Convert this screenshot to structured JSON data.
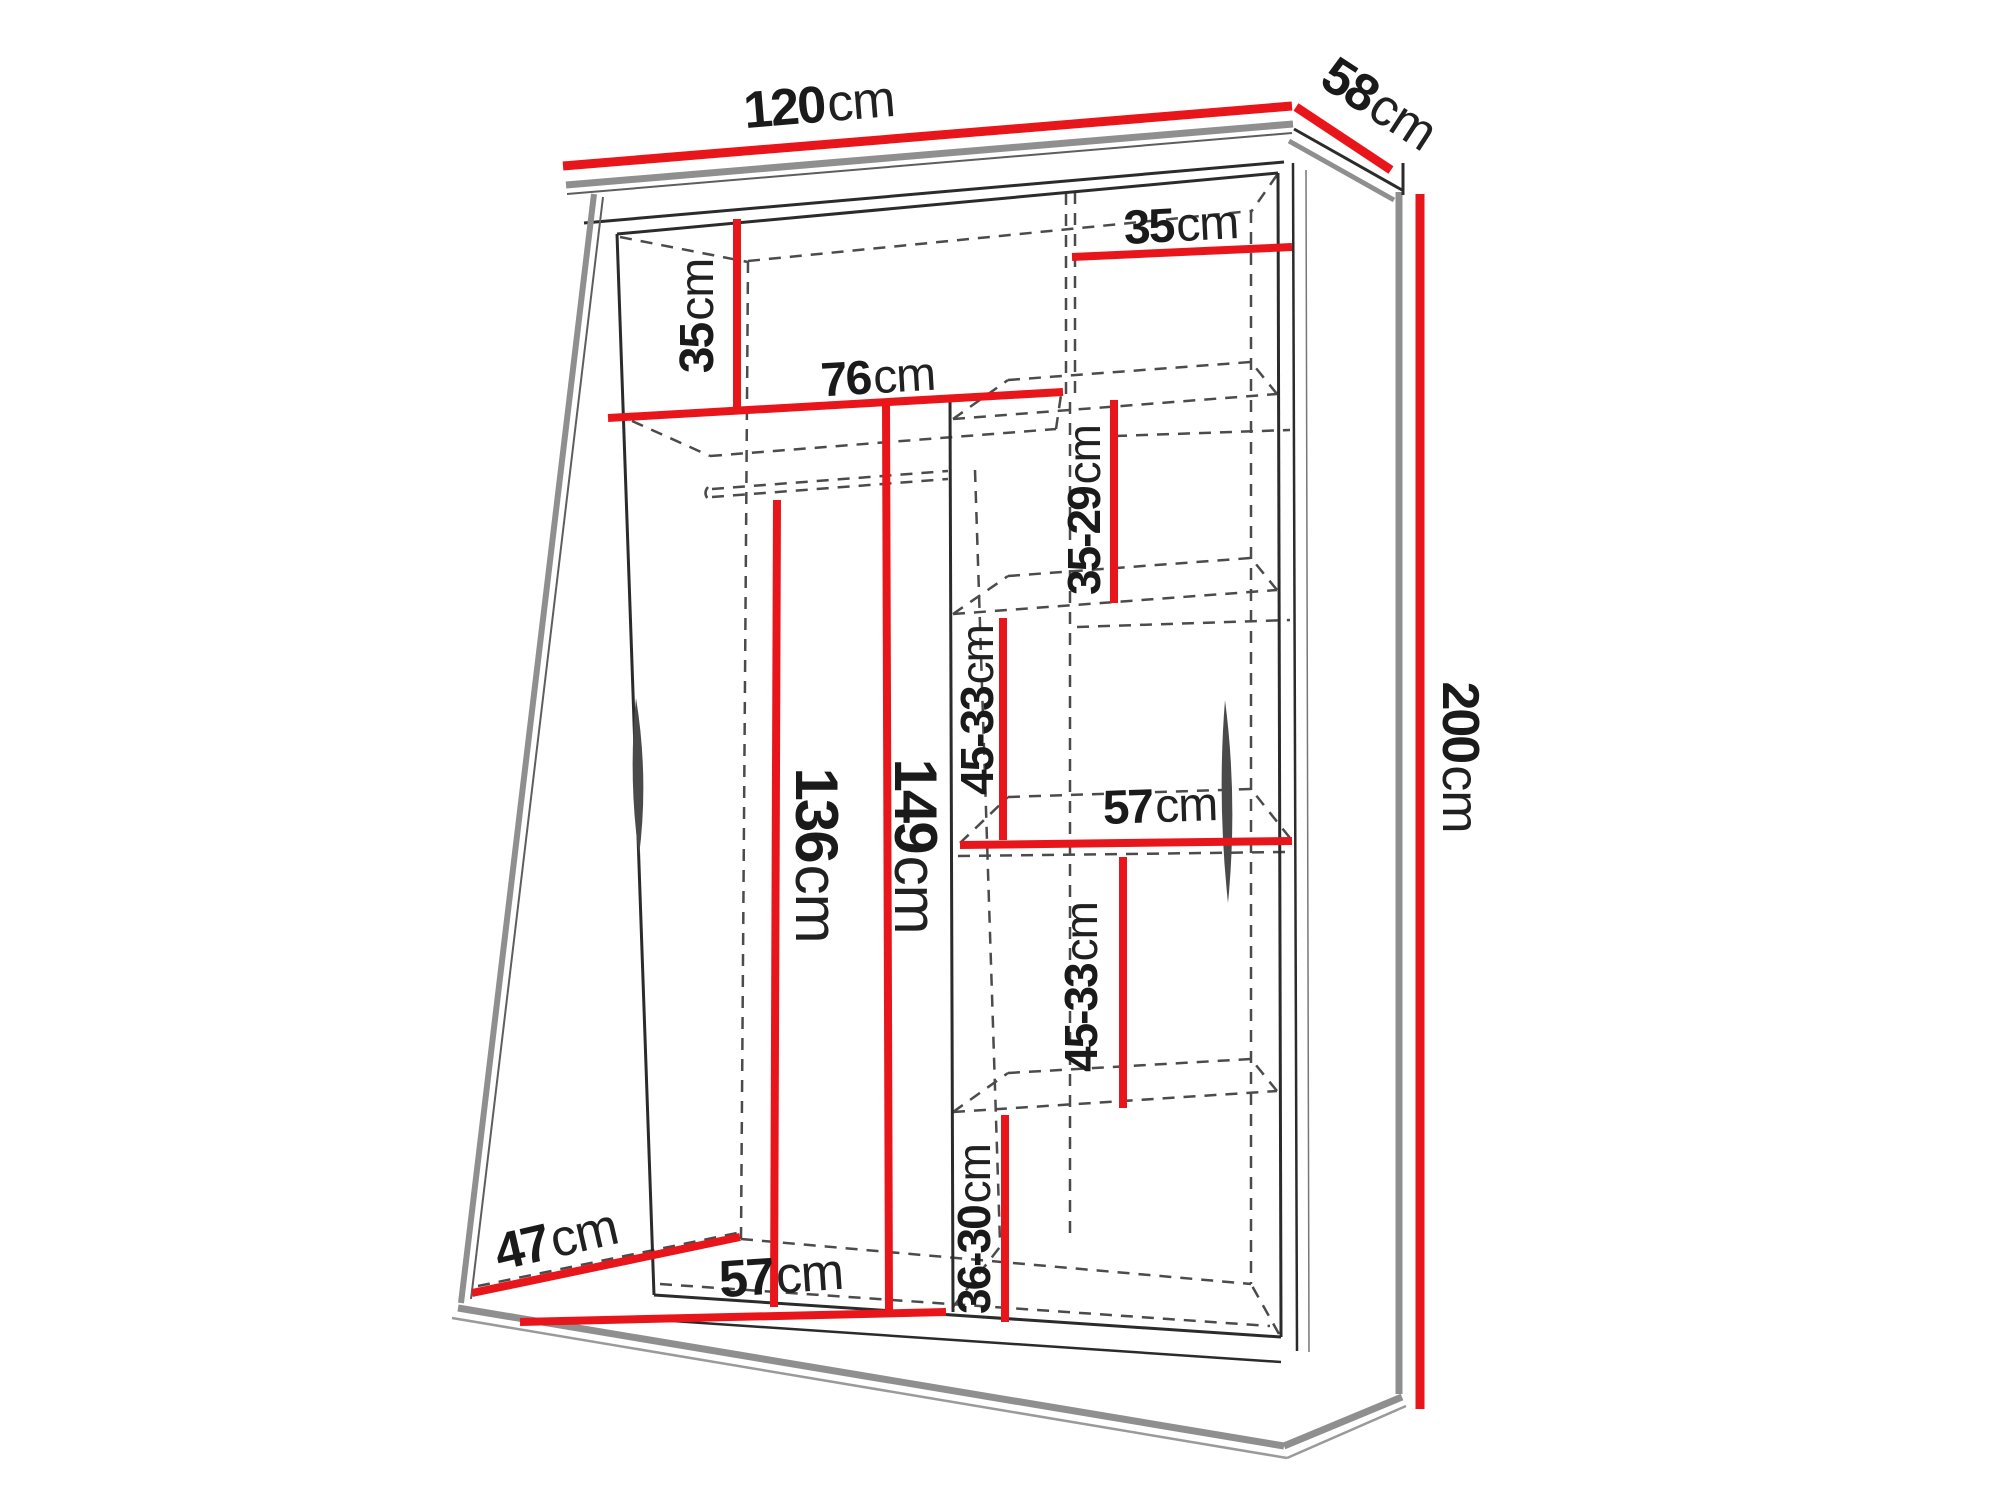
{
  "diagram": {
    "type": "furniture-dimension-drawing",
    "subject": "two-door sliding wardrobe with shelves and hanging rail",
    "unit": "cm"
  },
  "colors": {
    "dimension_line_red": "#e8161b",
    "edge_dark": "#2b2b2b",
    "edge_gray": "#8f8f8f",
    "hidden_edge_dash": "#4b4b4b",
    "label_text": "#1a1a1a",
    "background": "#ffffff"
  },
  "overall_dimensions": {
    "width": "120cm",
    "depth": "58cm",
    "height": "200cm"
  },
  "labels": {
    "w120": {
      "value": "120",
      "unit": "cm"
    },
    "d58": {
      "value": "58",
      "unit": "cm"
    },
    "h200": {
      "value": "200",
      "unit": "cm"
    },
    "h35l": {
      "value": "35",
      "unit": "cm"
    },
    "w35r": {
      "value": "35",
      "unit": "cm"
    },
    "w76": {
      "value": "76",
      "unit": "cm"
    },
    "h3529": {
      "value": "35-29",
      "unit": "cm"
    },
    "h4533a": {
      "value": "45-33",
      "unit": "cm"
    },
    "w57m": {
      "value": "57",
      "unit": "cm"
    },
    "h4533b": {
      "value": "45-33",
      "unit": "cm"
    },
    "h136": {
      "value": "136",
      "unit": "cm"
    },
    "h149": {
      "value": "149",
      "unit": "cm"
    },
    "h3630": {
      "value": "36-30",
      "unit": "cm"
    },
    "w57b": {
      "value": "57",
      "unit": "cm"
    },
    "d47": {
      "value": "47",
      "unit": "cm"
    }
  }
}
